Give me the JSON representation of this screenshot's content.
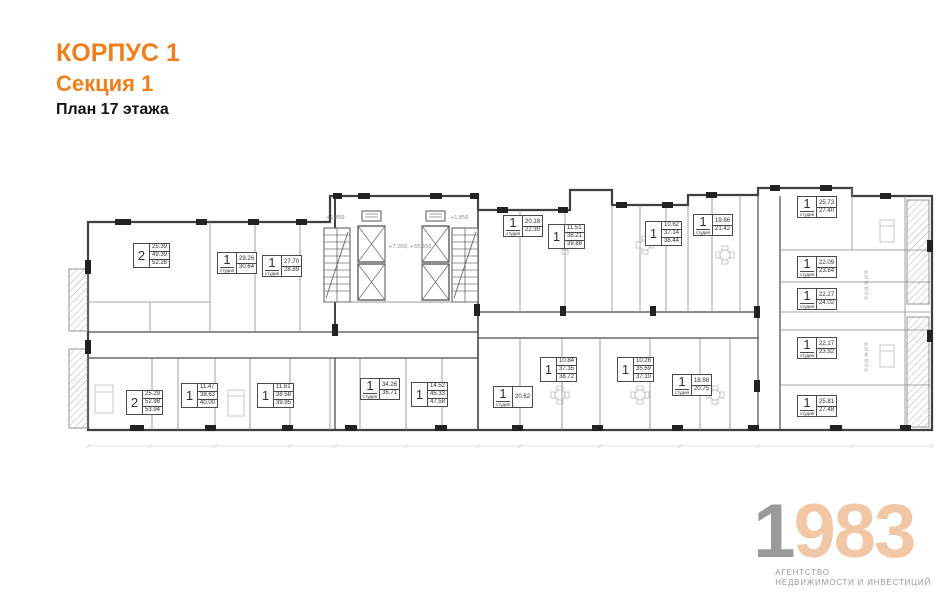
{
  "header": {
    "building": "КОРПУС 1",
    "section": "Секция 1",
    "plan_title": "План 17 этажа"
  },
  "colors": {
    "accent_orange": "#ef7f1a",
    "logo_gray": "#9a9a9a",
    "logo_peach": "#f2c7a6",
    "wall_dark": "#444444",
    "line_light": "#8a8a8a"
  },
  "plan": {
    "balcony_label": "лоджия",
    "core_marks": {
      "left": "+1.850",
      "right": "+1.850",
      "center": "+7.200; +55.350"
    },
    "apartments": [
      {
        "rooms": "2",
        "type": "",
        "areas": [
          "25.39",
          "49.39",
          "52.28"
        ],
        "x": 133,
        "y": 243
      },
      {
        "rooms": "1",
        "type": "студия",
        "areas": [
          "29.26",
          "30.64"
        ],
        "x": 217,
        "y": 252
      },
      {
        "rooms": "1",
        "type": "студия",
        "areas": [
          "27.70",
          "28.89"
        ],
        "x": 262,
        "y": 255
      },
      {
        "rooms": "1",
        "type": "студия",
        "areas": [
          "20.18",
          "22.30"
        ],
        "x": 503,
        "y": 215
      },
      {
        "rooms": "1",
        "type": "",
        "areas": [
          "11.51",
          "38.21",
          "39.88"
        ],
        "x": 548,
        "y": 224
      },
      {
        "rooms": "1",
        "type": "",
        "areas": [
          "10.62",
          "37.14",
          "38.44"
        ],
        "x": 645,
        "y": 221
      },
      {
        "rooms": "1",
        "type": "студия",
        "areas": [
          "19.86",
          "21.42"
        ],
        "x": 693,
        "y": 214
      },
      {
        "rooms": "1",
        "type": "студия",
        "areas": [
          "25.73",
          "27.40"
        ],
        "x": 797,
        "y": 196
      },
      {
        "rooms": "1",
        "type": "студия",
        "areas": [
          "22.09",
          "23.84"
        ],
        "x": 797,
        "y": 256
      },
      {
        "rooms": "1",
        "type": "студия",
        "areas": [
          "22.27",
          "24.02"
        ],
        "x": 797,
        "y": 288
      },
      {
        "rooms": "1",
        "type": "студия",
        "areas": [
          "22.17",
          "23.92"
        ],
        "x": 797,
        "y": 337
      },
      {
        "rooms": "1",
        "type": "студия",
        "areas": [
          "25.81",
          "27.48"
        ],
        "x": 797,
        "y": 395
      },
      {
        "rooms": "1",
        "type": "",
        "areas": [
          "10.84",
          "37.35",
          "38.72"
        ],
        "x": 540,
        "y": 357
      },
      {
        "rooms": "1",
        "type": "",
        "areas": [
          "10.26",
          "35.69",
          "37.10"
        ],
        "x": 617,
        "y": 357
      },
      {
        "rooms": "1",
        "type": "студия",
        "areas": [
          "18.98",
          "20.75"
        ],
        "x": 672,
        "y": 374
      },
      {
        "rooms": "1",
        "type": "студия",
        "areas": [
          "20.62"
        ],
        "x": 493,
        "y": 386
      },
      {
        "rooms": "1",
        "type": "студия",
        "areas": [
          "34.26",
          "36.71"
        ],
        "x": 360,
        "y": 378
      },
      {
        "rooms": "1",
        "type": "",
        "areas": [
          "14.52",
          "45.33",
          "47.58"
        ],
        "x": 411,
        "y": 382
      },
      {
        "rooms": "1",
        "type": "",
        "areas": [
          "11.47",
          "38.63",
          "40.00"
        ],
        "x": 181,
        "y": 383
      },
      {
        "rooms": "1",
        "type": "",
        "areas": [
          "11.61",
          "38.58",
          "39.95"
        ],
        "x": 257,
        "y": 383
      },
      {
        "rooms": "2",
        "type": "",
        "areas": [
          "25.29",
          "52.98",
          "53.94"
        ],
        "x": 126,
        "y": 390
      }
    ]
  },
  "logo": {
    "digit_gray": "1",
    "digit_accent": "983",
    "tagline_line1": "АГЕНТСТВО",
    "tagline_line2": "НЕДВИЖИМОСТИ И ИНВЕСТИЦИЙ"
  }
}
